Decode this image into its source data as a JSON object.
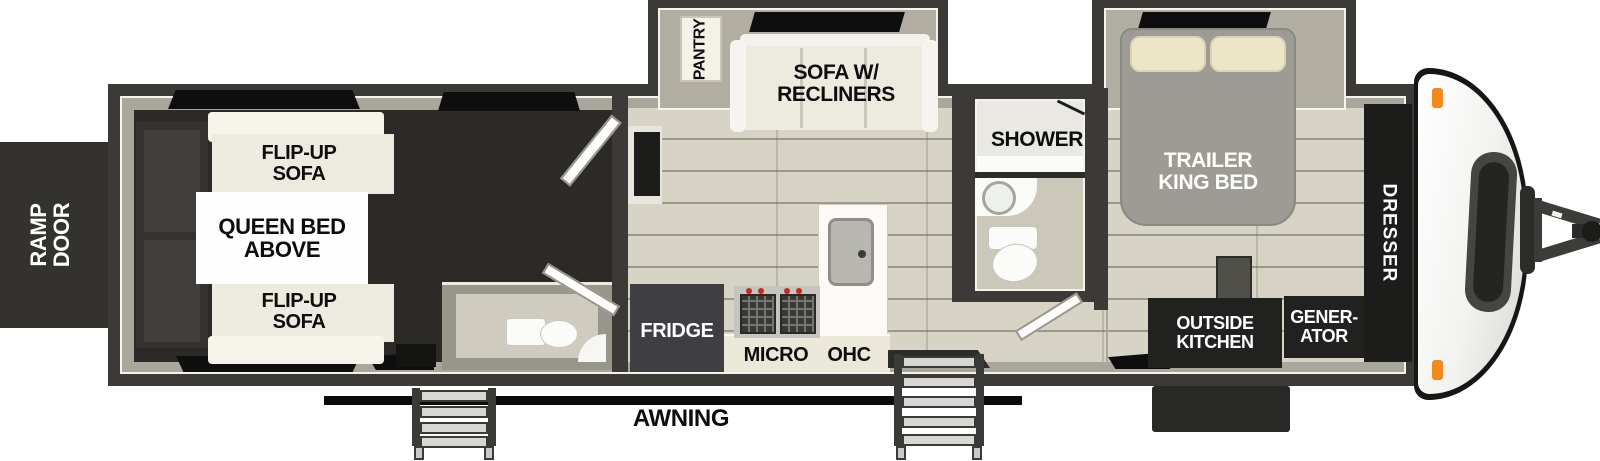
{
  "type": "rv-travel-trailer-floorplan",
  "labels": {
    "ramp_door": "RAMP\nDOOR",
    "garage": {
      "flip_up_sofa_top": "FLIP-UP\nSOFA",
      "queen_bed_above": "QUEEN BED\nABOVE",
      "flip_up_sofa_bottom": "FLIP-UP\nSOFA"
    },
    "living": {
      "pantry": "PANTRY",
      "sofa_w_recliners": "SOFA W/\nRECLINERS"
    },
    "kitchen": {
      "fridge": "FRIDGE",
      "micro": "MICRO",
      "ohc": "OHC"
    },
    "bathroom": {
      "shower": "SHOWER"
    },
    "bedroom": {
      "trailer_king_bed": "TRAILER\nKING BED",
      "outside_kitchen": "OUTSIDE\nKITCHEN",
      "generator": "GENER-\nATOR",
      "dresser": "DRESSER"
    },
    "exterior": {
      "awning": "AWNING"
    }
  },
  "colors": {
    "wall": "#3b3a36",
    "inner_wall": "#a9a69b",
    "garage_floor": "#2b2a27",
    "plank_floor": "#d7d3c5",
    "slide_interior": "#b1aea1",
    "furniture_white": "#edebe0",
    "dark_cabinet": "#21211f",
    "marker_light_orange": "#ee8a1f",
    "stove_knob_red": "#c8281e",
    "window_black": "#0e0e0e"
  }
}
